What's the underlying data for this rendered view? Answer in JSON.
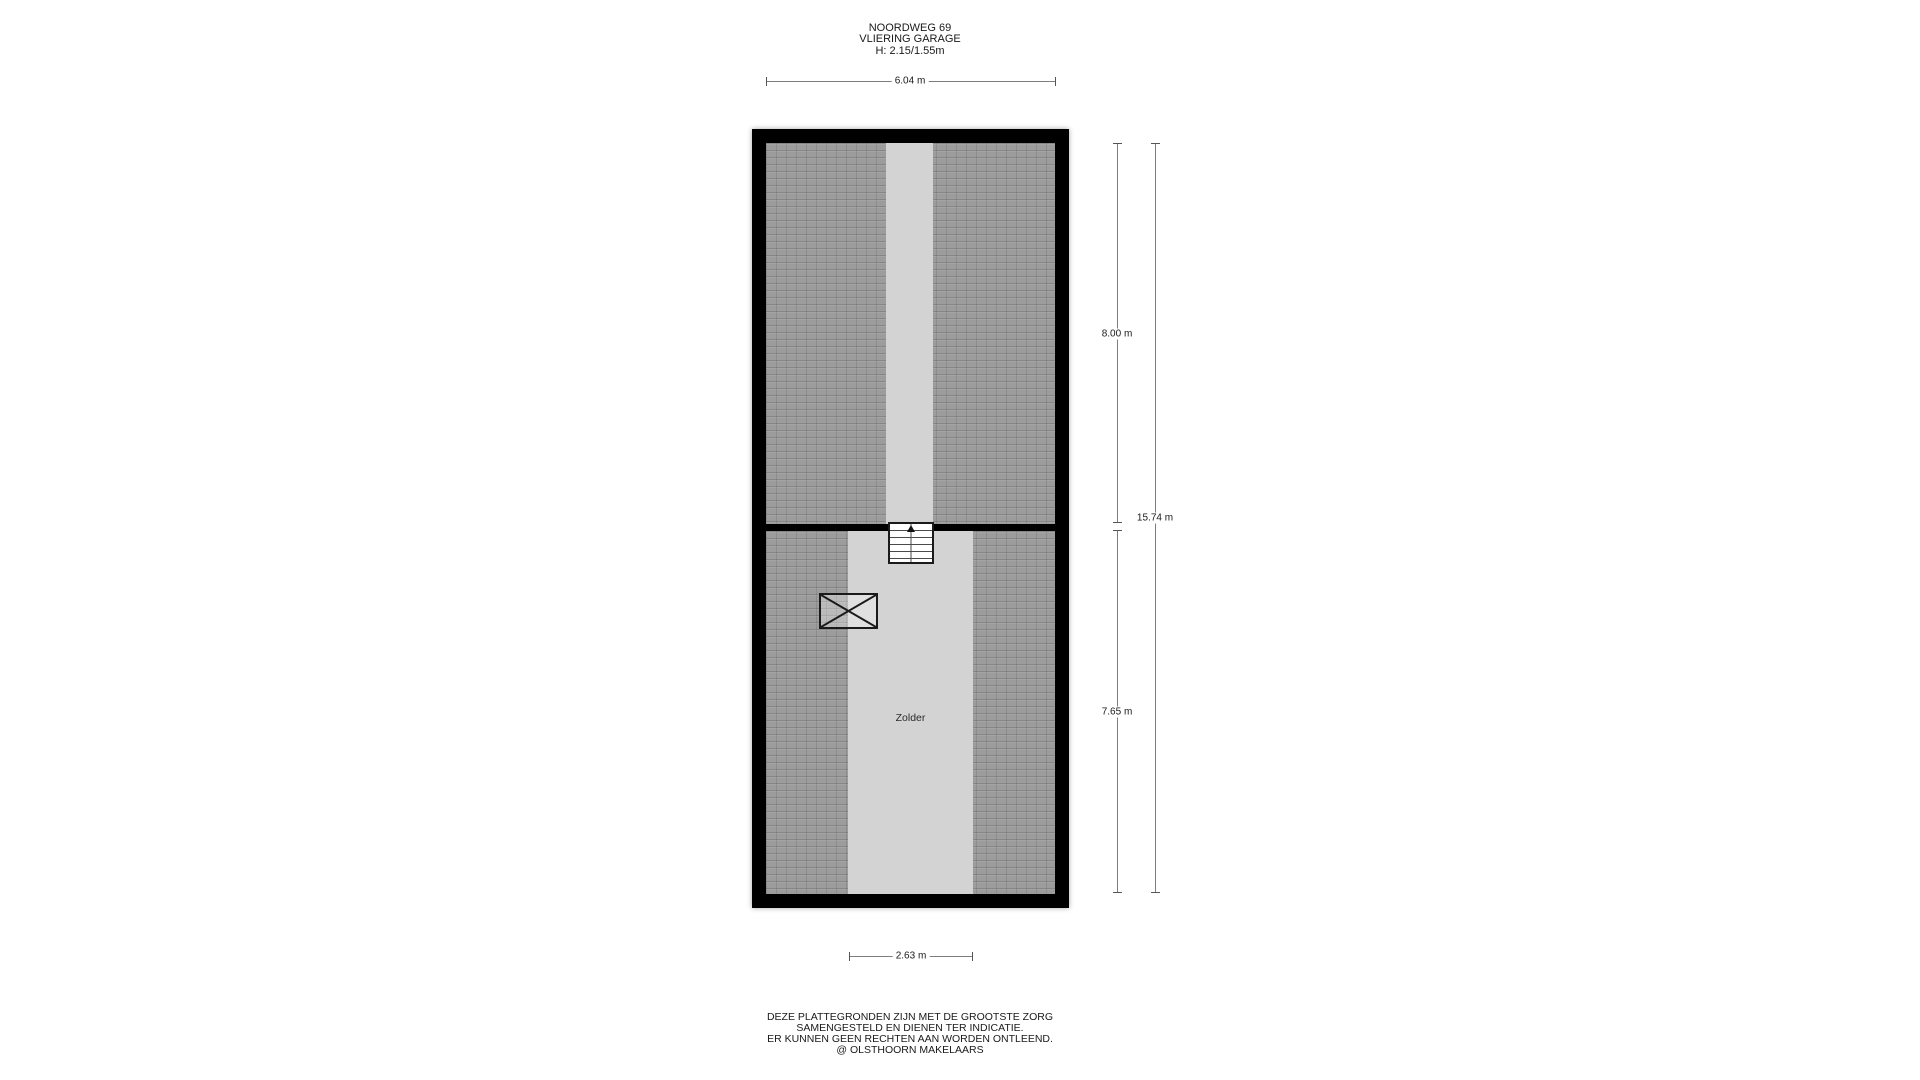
{
  "colors": {
    "wall": "#000000",
    "hatch": "#9c9c9c",
    "strip": "#d3d3d3",
    "dim_line": "#7d7d7d",
    "text": "#1a1a1a"
  },
  "title": {
    "address": "NOORDWEG 69",
    "floor_name": "VLIERING GARAGE",
    "heights": "H: 2.15/1.55m"
  },
  "floorplan": {
    "room_label": "Zolder",
    "stairs_direction": "up",
    "dimensions": {
      "inner_width": "6.04 m",
      "upper_section_height": "8.00 m",
      "total_height": "15.74 m",
      "lower_section_height": "7.65 m",
      "strip_width": "2.63 m"
    }
  },
  "footer": {
    "disclaimer_line1": "DEZE PLATTEGRONDEN ZIJN MET DE GROOTSTE ZORG",
    "disclaimer_line2": "SAMENGESTELD EN DIENEN TER INDICATIE.",
    "disclaimer_line3": "ER KUNNEN GEEN RECHTEN AAN WORDEN ONTLEEND.",
    "credit": "@ OLSTHOORN MAKELAARS"
  }
}
